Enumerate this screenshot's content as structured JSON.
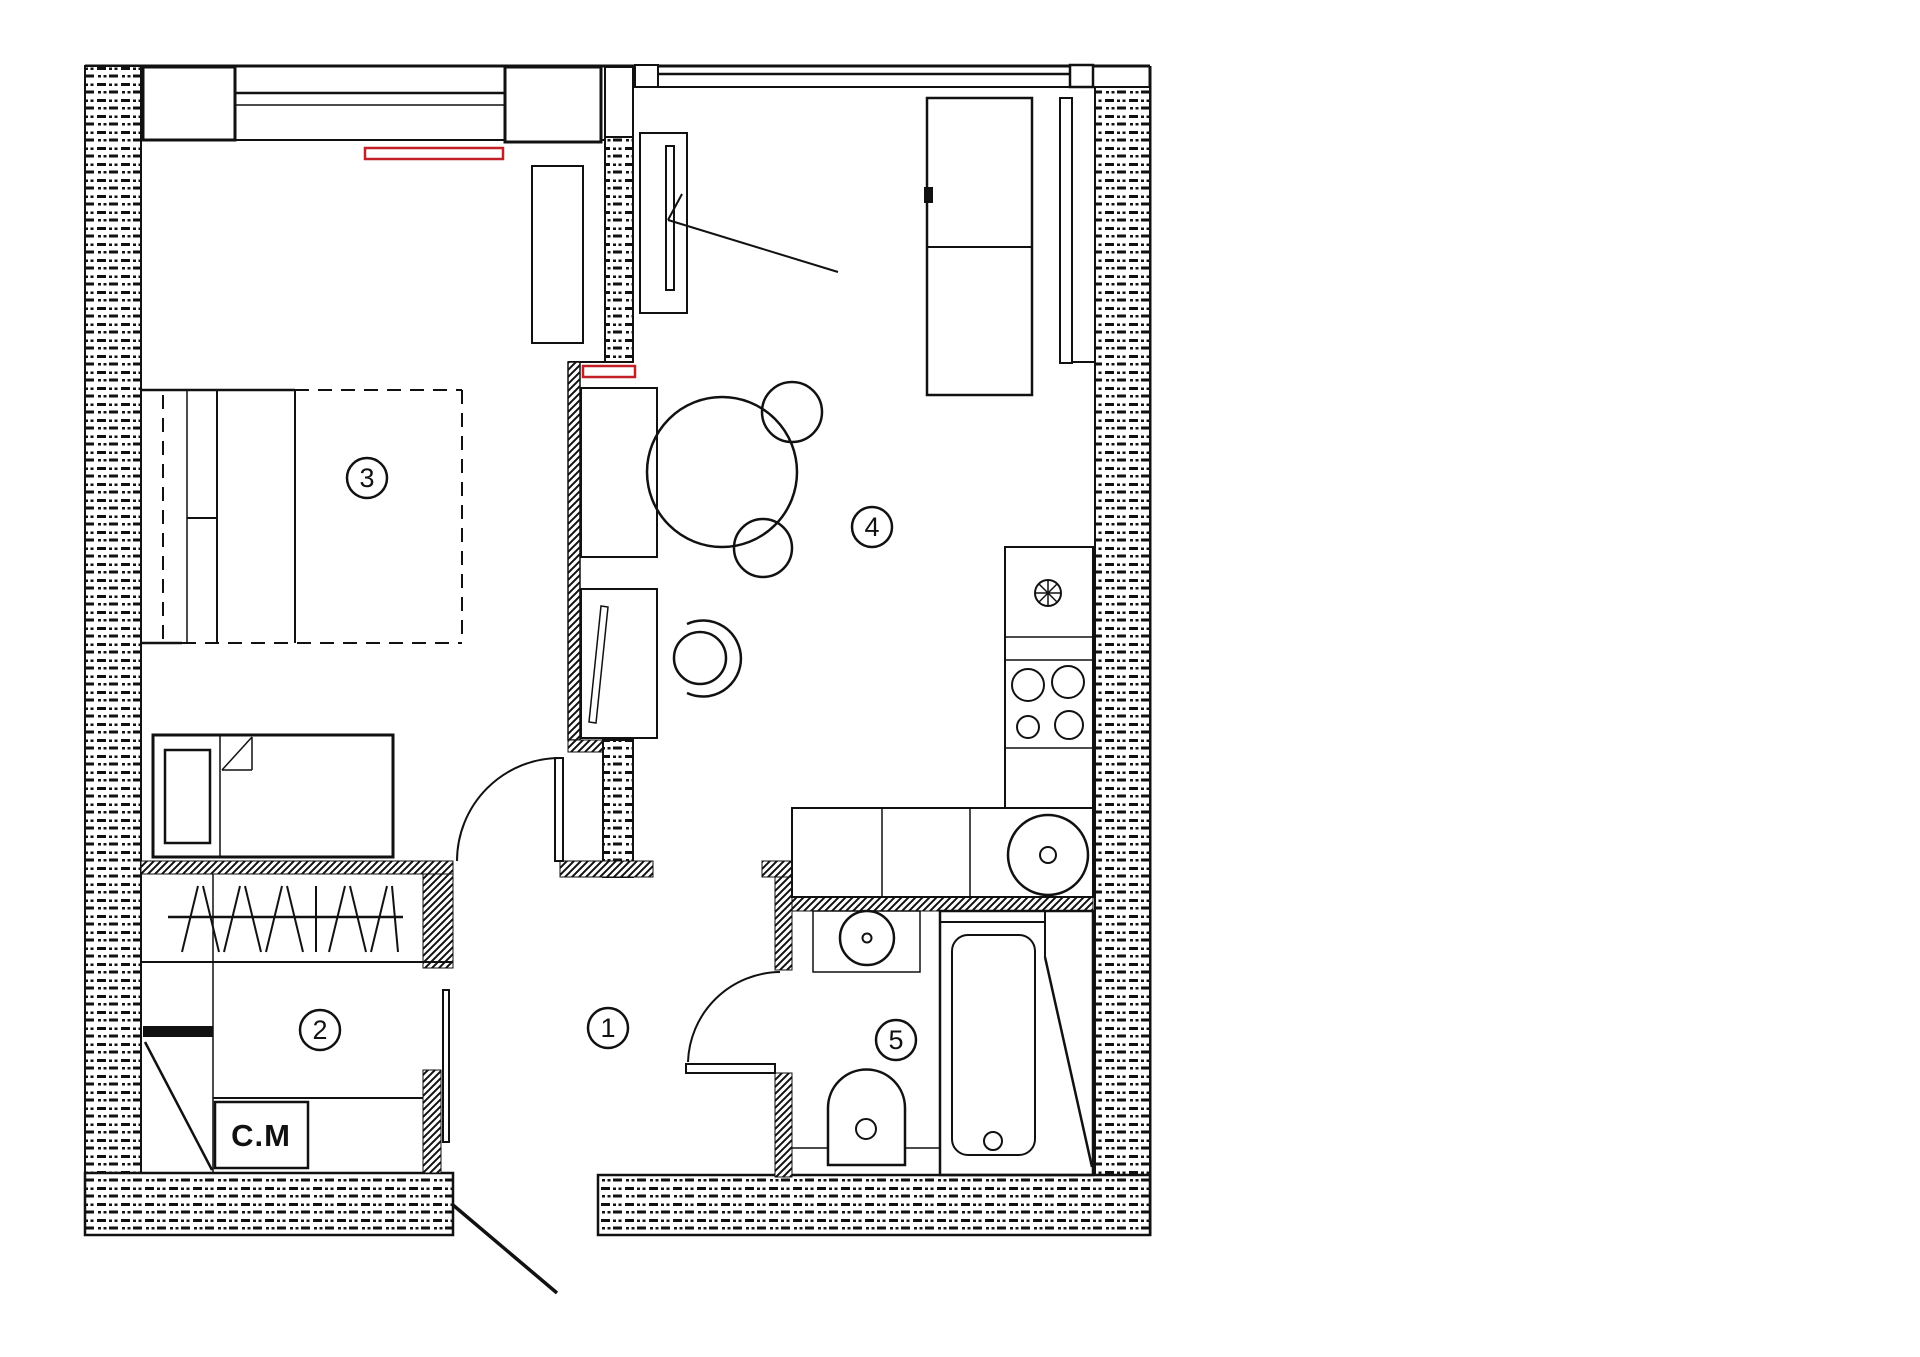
{
  "plan": {
    "title": "apartment-floor-plan",
    "colors": {
      "accent": "#c22026",
      "ink": "#111111",
      "paper": "#ffffff"
    },
    "rooms": [
      {
        "id": "hallway",
        "number": "1"
      },
      {
        "id": "dressing-laundry",
        "number": "2"
      },
      {
        "id": "bedroom",
        "number": "3"
      },
      {
        "id": "living-kitchen",
        "number": "4"
      },
      {
        "id": "bathroom",
        "number": "5"
      }
    ],
    "labels": {
      "washing_machine": "C.M"
    }
  }
}
